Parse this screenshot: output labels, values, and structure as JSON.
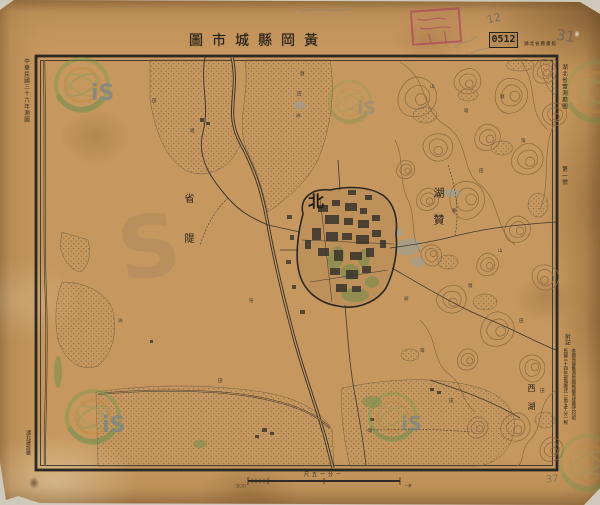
{
  "header": {
    "title": "圖市城縣岡黃",
    "catalog_stamp": "0512",
    "catalog_note": "湖北省圖書館",
    "pencil_top": "12",
    "pencil_right": "31"
  },
  "margins": {
    "left_top": "中華民國三十六年測圖",
    "right_top_1": "湖北省實測廳圖",
    "right_top_2": "第一號",
    "bottom_left": "湖北建設廳",
    "note_header": "附記",
    "note_col_1": "本圖係據舊測原圖縮繪而成圖式均照",
    "note_col_2": "民國三十四年部頒圖式一萬五千分一製",
    "pencil_bottom": "37"
  },
  "map": {
    "north": "北",
    "dike_label": "省隄",
    "lake_label": "湖贊",
    "west_lake": "西湖",
    "scatter": [
      {
        "x": 300,
        "y": 75,
        "t": "塘"
      },
      {
        "x": 297,
        "y": 95,
        "t": "田"
      },
      {
        "x": 296,
        "y": 117,
        "t": "洲"
      },
      {
        "x": 430,
        "y": 88,
        "t": "山"
      },
      {
        "x": 464,
        "y": 112,
        "t": "坡"
      },
      {
        "x": 500,
        "y": 98,
        "t": "塘"
      },
      {
        "x": 521,
        "y": 142,
        "t": "灣"
      },
      {
        "x": 479,
        "y": 172,
        "t": "田"
      },
      {
        "x": 452,
        "y": 212,
        "t": "廟"
      },
      {
        "x": 498,
        "y": 252,
        "t": "山"
      },
      {
        "x": 468,
        "y": 287,
        "t": "塘"
      },
      {
        "x": 519,
        "y": 322,
        "t": "田"
      },
      {
        "x": 420,
        "y": 352,
        "t": "灣"
      },
      {
        "x": 449,
        "y": 402,
        "t": "田"
      },
      {
        "x": 368,
        "y": 432,
        "t": "塘"
      },
      {
        "x": 249,
        "y": 302,
        "t": "窑"
      },
      {
        "x": 218,
        "y": 382,
        "t": "田"
      },
      {
        "x": 118,
        "y": 322,
        "t": "洲"
      },
      {
        "x": 152,
        "y": 102,
        "t": "田"
      },
      {
        "x": 190,
        "y": 132,
        "t": "塘"
      },
      {
        "x": 404,
        "y": 300,
        "t": "坡"
      },
      {
        "x": 540,
        "y": 392,
        "t": "田"
      }
    ]
  },
  "scale": {
    "caption": "尺五一分一",
    "left": "五〇〇",
    "right": "一粁"
  },
  "watermark": {
    "letters": "iS",
    "big_s": "S"
  },
  "colors": {
    "paper": "#c6975e",
    "ink": "#2f2b26",
    "contour": "#8a6a42",
    "stamp_red": "#b04a5e",
    "watermark_green": "#6f9e4f",
    "vegetation": "#77904c"
  }
}
